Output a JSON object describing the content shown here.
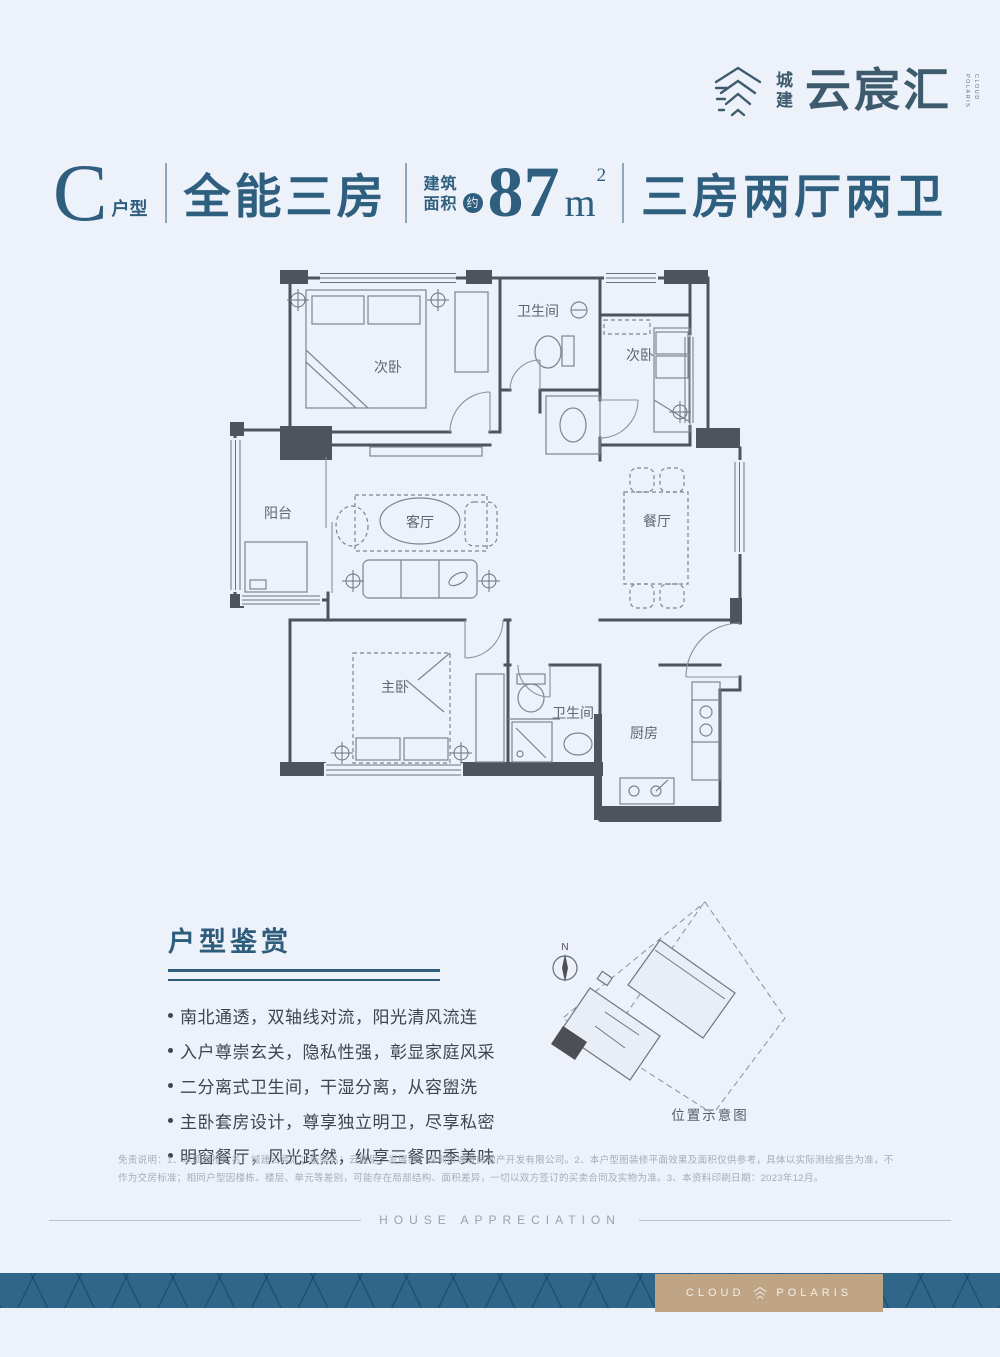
{
  "logo": {
    "brand_vertical": "城建",
    "brand_main": "云宸汇",
    "tagline_1": "POLARIS",
    "tagline_2": "CLOUD"
  },
  "title": {
    "type_letter": "C",
    "type_suffix": "户型",
    "name": "全能三房",
    "area_label_1": "建筑",
    "area_label_2": "面积",
    "area_approx": "约",
    "area_value": "87",
    "area_unit": "m",
    "area_exp": "2",
    "layout": "三房两厅两卫"
  },
  "floorplan": {
    "rooms": {
      "bedroom_top_left": "次卧",
      "bath_top": "卫生间",
      "bedroom_top_right": "次卧",
      "balcony": "阳台",
      "living": "客厅",
      "dining": "餐厅",
      "master": "主卧",
      "bath_bottom": "卫生间",
      "kitchen": "厨房"
    }
  },
  "appreciation": {
    "title": "户型鉴赏",
    "bullets": [
      "南北通透，双轴线对流，阳光清风流连",
      "入户尊崇玄关，隐私性强，彰显家庭风采",
      "二分离式卫生间，干湿分离，从容盥洗",
      "主卧套房设计，尊享独立明卫，尽享私密",
      "明窗餐厅，风光跃然，纵享三餐四季美味"
    ]
  },
  "siteplan": {
    "compass_label": "N",
    "caption": "位置示意图"
  },
  "disclaimer": {
    "text": "免责说明：1、本项目推广名：城建云宸汇；备案名：云宸里；发展商：深圳市城发房地产开发有限公司。2、本户型图装修平面效果及面积仅供参考，具体以实际测绘报告为准，不作为交房标准；相同户型因楼栋、楼层、单元等差别，可能存在局部结构、面积差异，一切以双方签订的买卖合同及实物为准。3、本资料印刷日期：2023年12月。"
  },
  "footer": {
    "divider_label": "HOUSE APPRECIATION",
    "brand_left": "CLOUD",
    "brand_right": "POLARIS"
  },
  "colors": {
    "background": "#edf1f9",
    "accent_blue": "#2e5f7e",
    "plan_wall": "#4f545c",
    "banner_teal": "#31668b",
    "brand_gold": "#bfa486"
  }
}
